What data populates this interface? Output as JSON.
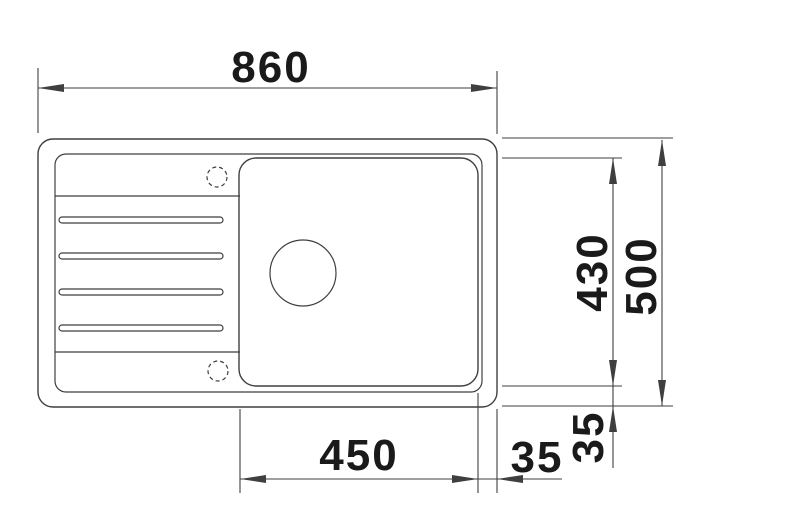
{
  "drawing": {
    "kind": "sink-top-view-dimension-drawing",
    "dimensions": {
      "overall_width": "860",
      "overall_depth": "500",
      "bowl_depth": "430",
      "bowl_width": "450",
      "bowl_offset_right": "35",
      "bowl_offset_bottom": "35"
    },
    "features": {
      "drainboard_grooves": 4,
      "tap_holes": 2,
      "bowl_drains": 1
    },
    "colors": {
      "line": "#3f3f3f",
      "text": "#1a1a1a",
      "background": "#ffffff"
    }
  }
}
